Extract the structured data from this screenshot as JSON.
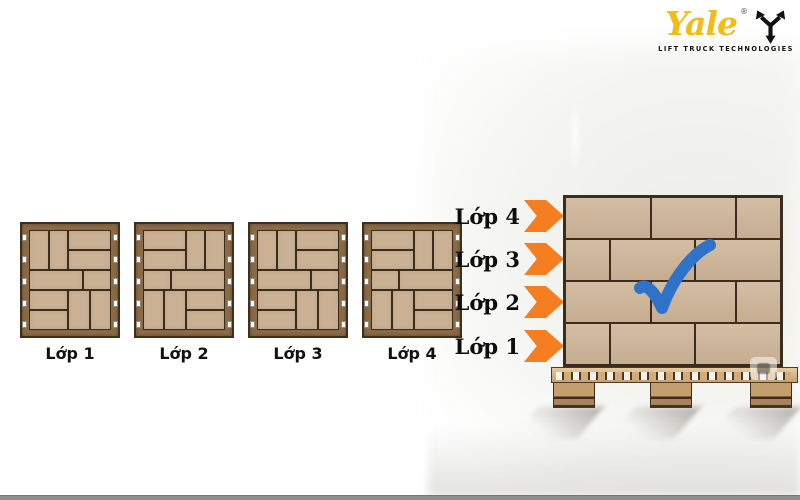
{
  "brand": {
    "name": "Yale",
    "registered": "®",
    "tagline": "LIFT TRUCK TECHNOLOGIES",
    "mark": "three-prong-fork-icon"
  },
  "layer_diagrams": {
    "items": [
      {
        "label": "Lớp 1",
        "pattern": "A"
      },
      {
        "label": "Lớp 2",
        "pattern": "B"
      },
      {
        "label": "Lớp 3",
        "pattern": "A"
      },
      {
        "label": "Lớp 4",
        "pattern": "B"
      }
    ],
    "patterns": {
      "A": [
        {
          "x": 0,
          "y": 0,
          "w": 24,
          "h": 40
        },
        {
          "x": 24,
          "y": 0,
          "w": 24,
          "h": 40
        },
        {
          "x": 48,
          "y": 0,
          "w": 52,
          "h": 20
        },
        {
          "x": 48,
          "y": 20,
          "w": 52,
          "h": 20
        },
        {
          "x": 0,
          "y": 40,
          "w": 66,
          "h": 20
        },
        {
          "x": 66,
          "y": 40,
          "w": 34,
          "h": 20
        },
        {
          "x": 0,
          "y": 60,
          "w": 48,
          "h": 20
        },
        {
          "x": 0,
          "y": 80,
          "w": 48,
          "h": 20
        },
        {
          "x": 48,
          "y": 60,
          "w": 26,
          "h": 40
        },
        {
          "x": 74,
          "y": 60,
          "w": 26,
          "h": 40
        }
      ],
      "B": [
        {
          "x": 0,
          "y": 0,
          "w": 52,
          "h": 20
        },
        {
          "x": 0,
          "y": 20,
          "w": 52,
          "h": 20
        },
        {
          "x": 52,
          "y": 0,
          "w": 24,
          "h": 40
        },
        {
          "x": 76,
          "y": 0,
          "w": 24,
          "h": 40
        },
        {
          "x": 0,
          "y": 40,
          "w": 34,
          "h": 20
        },
        {
          "x": 34,
          "y": 40,
          "w": 66,
          "h": 20
        },
        {
          "x": 0,
          "y": 60,
          "w": 26,
          "h": 40
        },
        {
          "x": 26,
          "y": 60,
          "w": 26,
          "h": 40
        },
        {
          "x": 52,
          "y": 60,
          "w": 48,
          "h": 20
        },
        {
          "x": 52,
          "y": 80,
          "w": 48,
          "h": 20
        }
      ]
    }
  },
  "stack": {
    "legend": [
      {
        "label": "Lớp 4"
      },
      {
        "label": "Lớp 3"
      },
      {
        "label": "Lớp 2"
      },
      {
        "label": "Lớp 1"
      }
    ],
    "rows": [
      [
        40,
        39,
        21
      ],
      [
        21,
        39,
        40
      ],
      [
        40,
        39,
        21
      ],
      [
        21,
        39,
        40
      ]
    ],
    "status": "correct-checkmark"
  },
  "colors": {
    "arrow_orange": "#f57e20",
    "check_blue": "#2e73c9",
    "box_tan": "#cdb69c",
    "box_line": "#3a2d20",
    "frame_brown": "#8a6a45",
    "diagram_box": "#cbb193",
    "deck_wood": "#d9b88a",
    "leg_wood": "#c59e6d",
    "logo_gold": "#f2bb16"
  }
}
